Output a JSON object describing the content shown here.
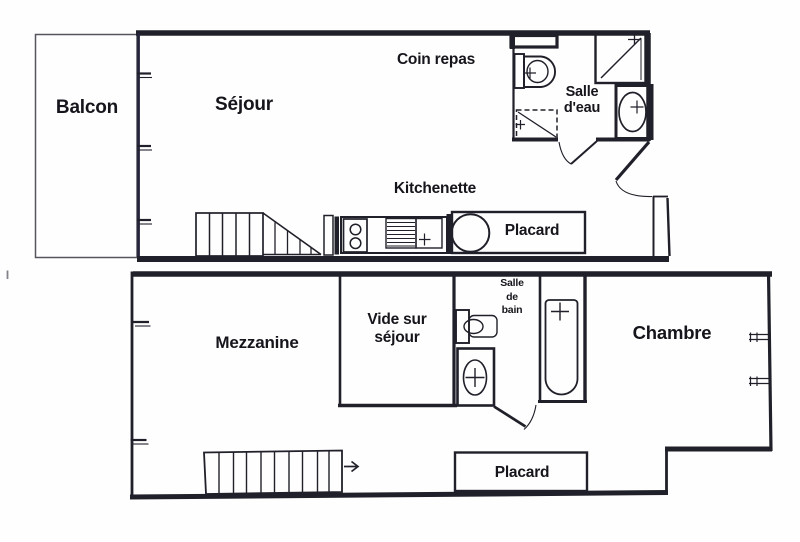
{
  "plan": {
    "title": "Apartment floor plan",
    "ink_color": "#20202a",
    "background_color": "#fefefe",
    "upper_floor": {
      "balcon": "Balcon",
      "sejour": "Séjour",
      "coin_repas": "Coin repas",
      "kitchenette": "Kitchenette",
      "salle_eau": "Salle d'eau",
      "placard": "Placard"
    },
    "lower_floor": {
      "mezzanine": "Mezzanine",
      "vide_sur_sejour": "Vide sur séjour",
      "salle_de_bain": "Salle de bain",
      "chambre": "Chambre",
      "placard": "Placard"
    }
  }
}
